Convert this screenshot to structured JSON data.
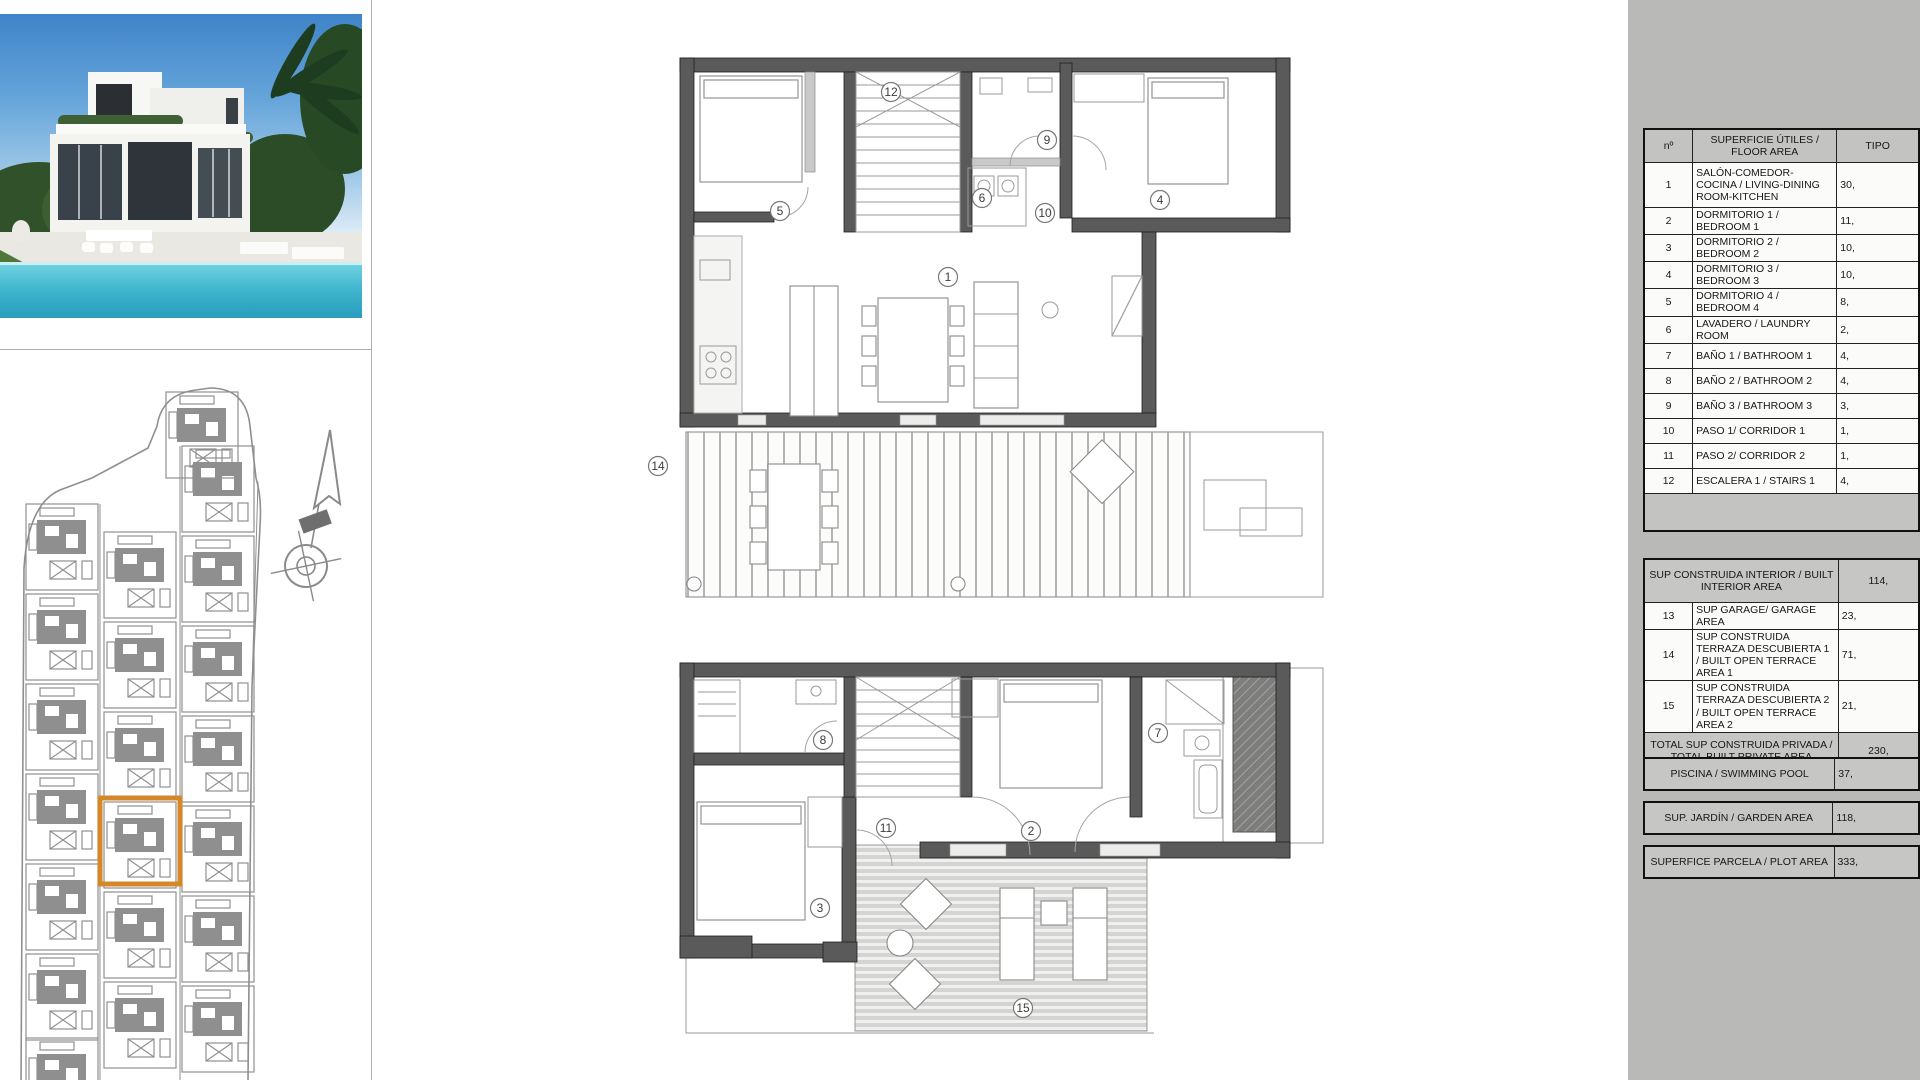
{
  "colors": {
    "highlight_orange": "#d4882a",
    "panel_gray": "#b9b9b7",
    "plan_gray": "#8f8f8f",
    "wall_gray": "#5a5a5a",
    "pool_teal": "#1f93b4"
  },
  "area_table": {
    "header": {
      "no": "nº",
      "area": "SUPERFICIE ÚTILES / FLOOR AREA",
      "tipo": "TIPO"
    },
    "rooms": [
      {
        "no": "1",
        "label": "SALÓN-COMEDOR-COCINA / LIVING-DINING ROOM-KITCHEN",
        "value": "30,"
      },
      {
        "no": "2",
        "label": "DORMITORIO 1 / BEDROOM 1",
        "value": "11,"
      },
      {
        "no": "3",
        "label": "DORMITORIO 2 / BEDROOM 2",
        "value": "10,"
      },
      {
        "no": "4",
        "label": "DORMITORIO 3 / BEDROOM 3",
        "value": "10,"
      },
      {
        "no": "5",
        "label": "DORMITORIO 4 / BEDROOM 4",
        "value": "8,"
      },
      {
        "no": "6",
        "label": "LAVADERO / LAUNDRY ROOM",
        "value": "2,"
      },
      {
        "no": "7",
        "label": "BAÑO 1 / BATHROOM 1",
        "value": "4,"
      },
      {
        "no": "8",
        "label": "BAÑO 2 / BATHROOM 2",
        "value": "4,"
      },
      {
        "no": "9",
        "label": "BAÑO 3 / BATHROOM 3",
        "value": "3,"
      },
      {
        "no": "10",
        "label": "PASO 1/ CORRIDOR 1",
        "value": "1,"
      },
      {
        "no": "11",
        "label": "PASO 2/ CORRIDOR 2",
        "value": "1,"
      },
      {
        "no": "12",
        "label": "ESCALERA 1 / STAIRS 1",
        "value": "4,"
      }
    ],
    "built": [
      {
        "no": "",
        "label": "SUP CONSTRUIDA INTERIOR / BUILT INTERIOR AREA",
        "value": "114,"
      },
      {
        "no": "13",
        "label": "SUP GARAGE/ GARAGE AREA",
        "value": "23,"
      },
      {
        "no": "14",
        "label": "SUP CONSTRUIDA TERRAZA DESCUBIERTA 1 / BUILT OPEN TERRACE AREA 1",
        "value": "71,"
      },
      {
        "no": "15",
        "label": "SUP CONSTRUIDA TERRAZA DESCUBIERTA 2 / BUILT OPEN TERRACE AREA 2",
        "value": "21,"
      },
      {
        "no": "",
        "label": "TOTAL SUP CONSTRUIDA PRIVADA / TOTAL BUILT PRIVATE AREA",
        "value": "230,"
      }
    ],
    "extras": [
      {
        "label": "PISCINA / SWIMMING POOL",
        "value": "37,"
      },
      {
        "label": "SUP. JARDÍN / GARDEN AREA",
        "value": "118,"
      },
      {
        "label": "SUPERFICE PARCELA / PLOT AREA",
        "value": "333,"
      }
    ]
  },
  "plans": {
    "upper_labels": [
      "12",
      "9",
      "5",
      "6",
      "10",
      "4",
      "1",
      "14"
    ],
    "lower_labels": [
      "8",
      "7",
      "11",
      "2",
      "3",
      "15"
    ]
  }
}
